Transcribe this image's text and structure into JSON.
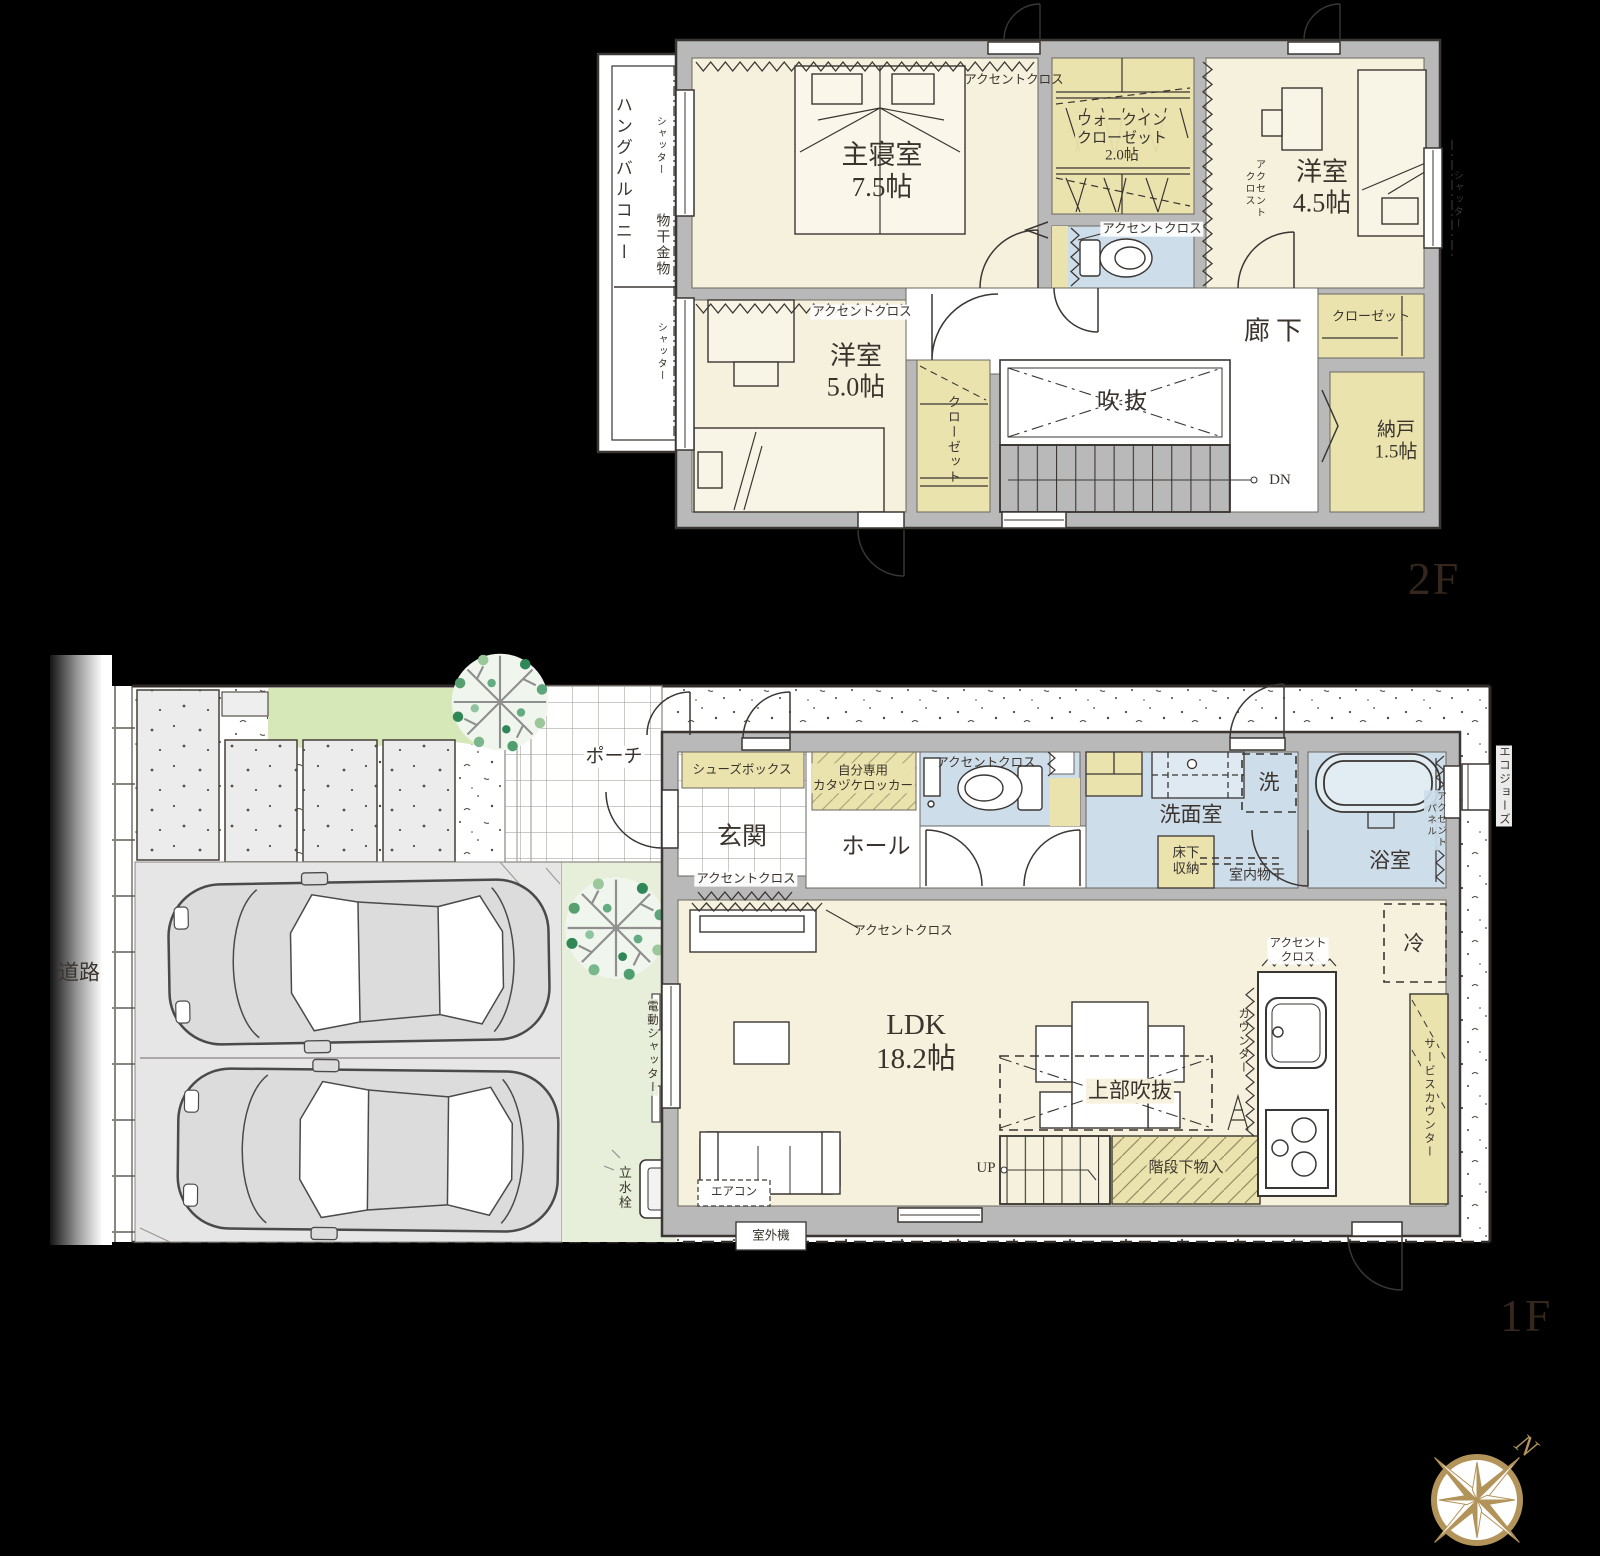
{
  "floor2": {
    "floor_label": "2F",
    "hang_balcony": "ハングバルコニー",
    "shutter": "シャッター",
    "laundry_hardware": "物干金物",
    "accent_cloth": "アクセントクロス",
    "accent_cloth_wrapped": "アクセント\nクロス",
    "master_bedroom": "主寝室\n7.5帖",
    "walk_in_closet": "ウォークイン\nクローゼット\n2.0帖",
    "western_room_45": "洋室\n4.5帖",
    "western_room_50": "洋室\n5.0帖",
    "hallway": "廊下",
    "storeroom": "納戸\n1.5帖",
    "closet": "クローゼット",
    "void": "吹抜",
    "down": "DN"
  },
  "floor1": {
    "floor_label": "1F",
    "road": "道路",
    "porch": "ポーチ",
    "entrance": "玄関",
    "hall": "ホール",
    "shoe_box": "シューズボックス",
    "personal_locker": "自分専用\nカタヅケロッカー",
    "accent_cloth": "アクセントクロス",
    "accent_cloth_wrapped": "アクセント\nクロス",
    "washroom": "洗面室",
    "washer": "洗",
    "underfloor_storage": "床下\n収納",
    "indoor_drying": "室内物干",
    "bathroom": "浴室",
    "accent_panel": "アクセント\nパネル",
    "eco_jozu": "エコジョーズ",
    "fridge": "冷",
    "counter": "カウンター",
    "service_counter": "サービスカウンター",
    "ldk": "LDK\n18.2帖",
    "upper_void": "上部吹抜",
    "up": "UP",
    "under_stairs_storage": "階段下物入",
    "air_conditioner": "エアコン",
    "outdoor_unit": "室外機",
    "water_tap": "立水栓",
    "electric_shutter": "電動シャッター"
  },
  "compass": {
    "north": "N"
  }
}
